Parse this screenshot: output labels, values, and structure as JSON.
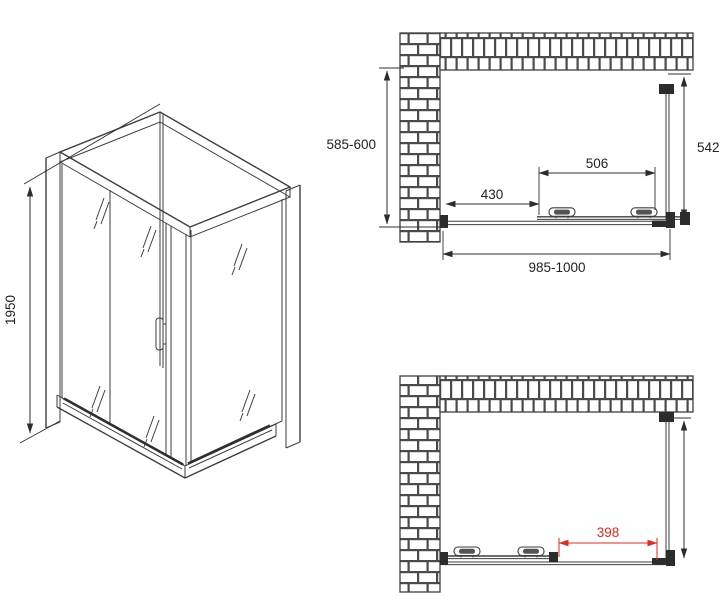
{
  "meta": {
    "description": "Technical drawing of a corner shower enclosure with sliding door: one isometric view and two plan views",
    "background": "#ffffff"
  },
  "colors": {
    "line": "#3e3e3e",
    "dimension": "#2f2f2f",
    "accent_red": "#e02a1e",
    "brick_fill": "#ffffff"
  },
  "views": {
    "isometric": {
      "name": "isometric view",
      "dims": {
        "height": {
          "label": "1950",
          "orientation": "vertical"
        }
      }
    },
    "plan_closed": {
      "name": "plan view, door closed",
      "dims": {
        "depth_range": {
          "label": "585-600"
        },
        "side_panel": {
          "label": "542"
        },
        "door_width": {
          "label": "506"
        },
        "wall_offset": {
          "label": "430"
        },
        "total_width": {
          "label": "985-1000"
        }
      }
    },
    "plan_open": {
      "name": "plan view, door open",
      "dims": {
        "opening": {
          "label": "398",
          "color": "red"
        }
      }
    }
  }
}
